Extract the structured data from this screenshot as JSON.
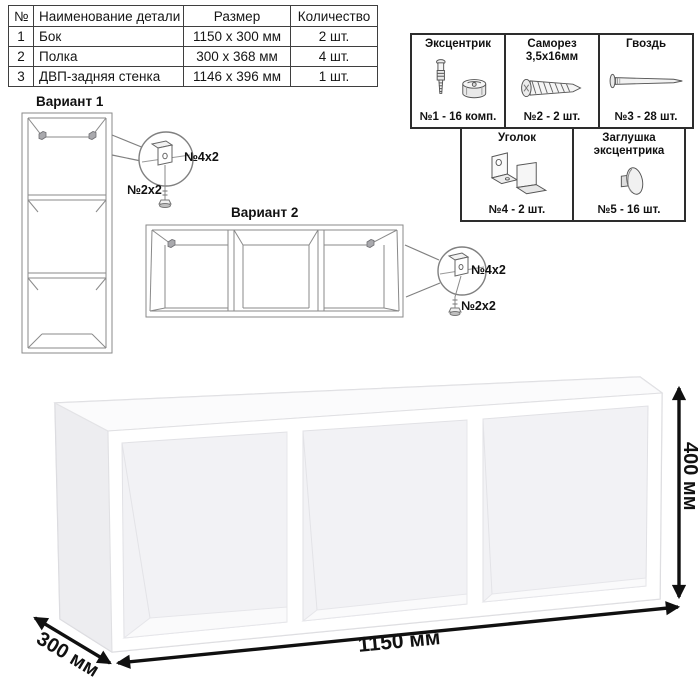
{
  "parts_table": {
    "headers": [
      "№",
      "Наименование детали",
      "Размер",
      "Количество"
    ],
    "rows": [
      {
        "num": "1",
        "name": "Бок",
        "size": "1150 х 300 мм",
        "qty": "2 шт."
      },
      {
        "num": "2",
        "name": "Полка",
        "size": "300 х 368 мм",
        "qty": "4 шт."
      },
      {
        "num": "3",
        "name": "ДВП-задняя стенка",
        "size": "1146 х 396 мм",
        "qty": "1 шт."
      }
    ]
  },
  "hardware": {
    "items": [
      {
        "title": "Эксцентрик",
        "title2": "",
        "count": "№1 - 16 комп.",
        "icon": "eccentric-cam-and-bolt-icon"
      },
      {
        "title": "Саморез",
        "title2": "3,5х16мм",
        "count": "№2 - 2 шт.",
        "icon": "screw-icon"
      },
      {
        "title": "Гвоздь",
        "title2": "",
        "count": "№3 - 28 шт.",
        "icon": "nail-icon"
      },
      {
        "title": "Уголок",
        "title2": "",
        "count": "№4 - 2 шт.",
        "icon": "angle-bracket-icon"
      },
      {
        "title": "Заглушка",
        "title2": "эксцентрика",
        "count": "№5 - 16 шт.",
        "icon": "eccentric-cap-icon"
      }
    ]
  },
  "variant1": {
    "label": "Вариант 1",
    "bracket_label": "№4х2",
    "screw_label": "№2х2"
  },
  "variant2": {
    "label": "Вариант 2",
    "bracket_label": "№4х2",
    "screw_label": "№2х2"
  },
  "dimensions": {
    "width": "1150 мм",
    "depth": "300 мм",
    "height": "400 мм"
  },
  "colors": {
    "line_art": "#808080",
    "border": "#2d2d2d",
    "dimension": "#101010"
  }
}
